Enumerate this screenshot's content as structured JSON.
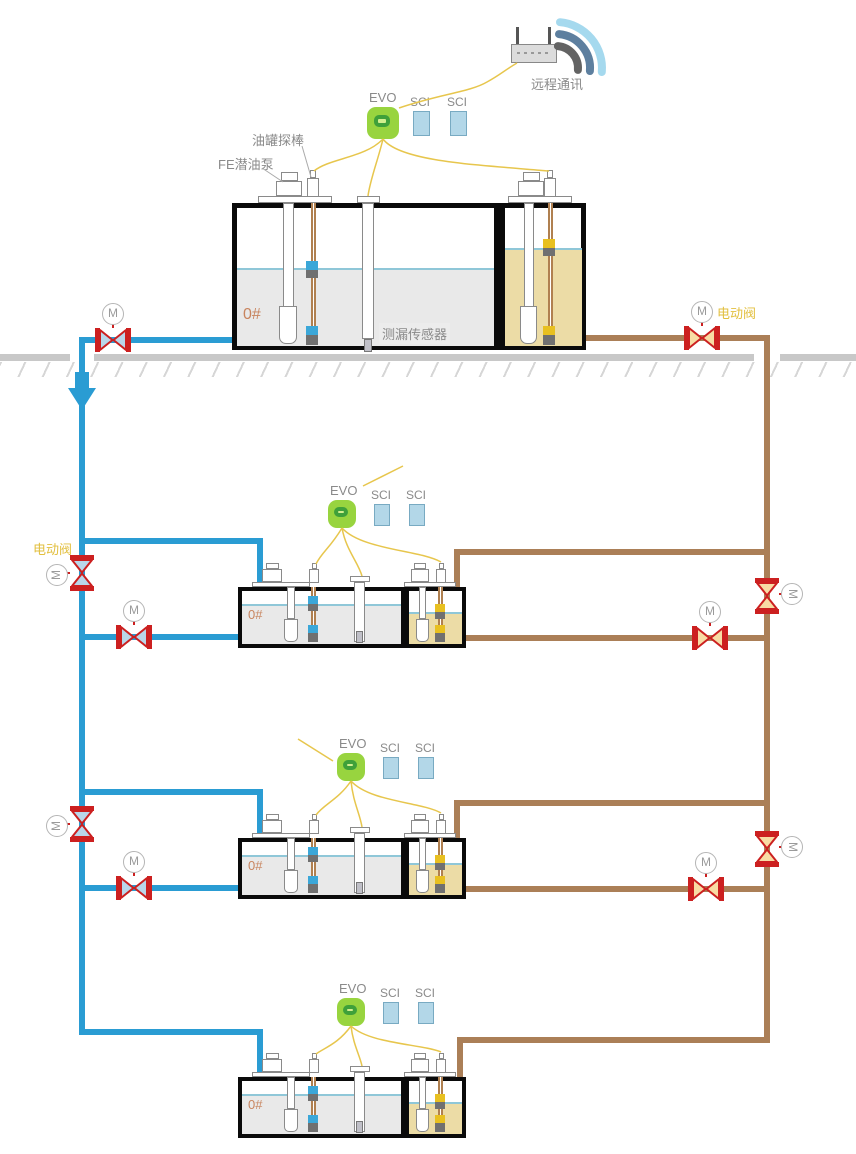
{
  "diagram_title": "fuel-tank-monitoring-system",
  "labels": {
    "remote_comm": "远程通讯",
    "tank_probe": "油罐探棒",
    "submersible_pump": "FE潜油泵",
    "leak_sensor": "测漏传感器",
    "electric_valve": "电动阀",
    "motor": "M"
  },
  "tiers": [
    {
      "controller": "EVO",
      "modules": [
        "SCI",
        "SCI"
      ],
      "fuel_grade": "0#"
    },
    {
      "controller": "EVO",
      "modules": [
        "SCI",
        "SCI"
      ],
      "fuel_grade": "0#"
    },
    {
      "controller": "EVO",
      "modules": [
        "SCI",
        "SCI"
      ],
      "fuel_grade": "0#"
    },
    {
      "controller": "EVO",
      "modules": [
        "SCI",
        "SCI"
      ],
      "fuel_grade": "0#"
    }
  ],
  "colors": {
    "pipe_diesel": "#2a9cd3",
    "pipe_gasoline": "#ab7f57",
    "valve_red": "#cc2020",
    "valve_fill_diesel": "#b9d7ea",
    "valve_fill_gasoline": "#f8dca4",
    "wire_yellow": "#e7c64d",
    "liquid_diesel": "#e9e9e9",
    "liquid_gasoline": "#ecdca6",
    "liquid_surface": "#8fc7d8",
    "evo_green": "#98d43f",
    "evo_ring": "#3fa03a",
    "evo_center": "#d3ef8e",
    "sci_fill": "#b3d7e8",
    "sci_border": "#78aac2",
    "ground_gray": "#c8c8c8",
    "label_gray": "#8a8a8a",
    "label_yellow": "#e2bf3e",
    "grade_orange": "#c8845e",
    "tank_border": "#0a0a0a"
  }
}
